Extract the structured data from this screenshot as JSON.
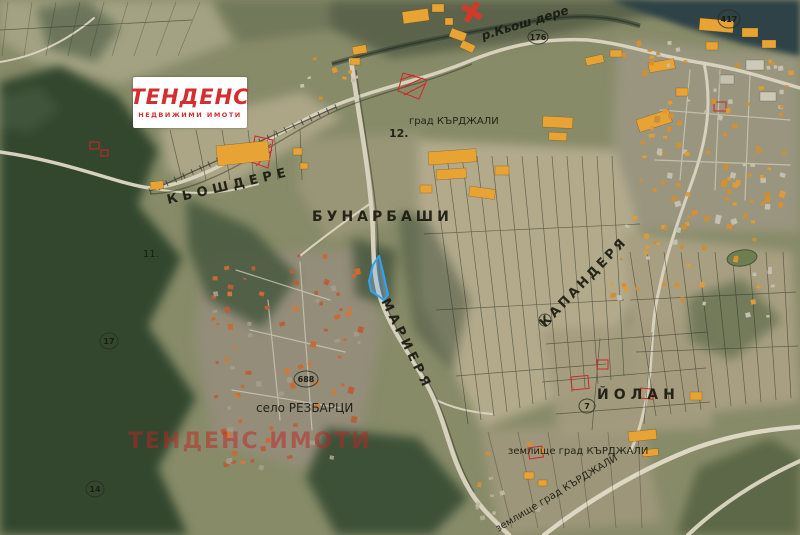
{
  "map": {
    "region_labels": {
      "kyoshdere": "КЬОШДЕРЕ",
      "bunarbashi": "БУНАРБАШИ",
      "mariera": "МАРИЕРЯ",
      "kapandera": "КАПАНДЕРЯ",
      "yolan": "ЙОЛАН",
      "selo_rezbartsi": "село РЕЗБАРЦИ",
      "zemlishte_grad_kardzhali": "землище град КЪРДЖАЛИ",
      "grad_kardzhali": "град КЪРДЖАЛИ",
      "reka_kyosh_dere": "р.Кьош дере"
    },
    "markers": {
      "m417": "417",
      "m176": "176",
      "m12": "12.",
      "m11": "11.",
      "m688": "688",
      "m17": "17",
      "m14": "14",
      "m7": "7"
    },
    "highlight_color": "#2da4f5",
    "colors": {
      "building_orange": "#e8a335",
      "red_parcel": "#cf2727",
      "forest_green": "#31462f",
      "water": "#2d4247",
      "road": "#d7d1bd"
    }
  },
  "branding": {
    "logo_title": "ТЕНДЕНС",
    "logo_subtitle": "НЕДВИЖИМИ ИМОТИ",
    "watermark": "ТЕНДЕНС ИМОТИ",
    "brand_red": "#d42f2f"
  }
}
